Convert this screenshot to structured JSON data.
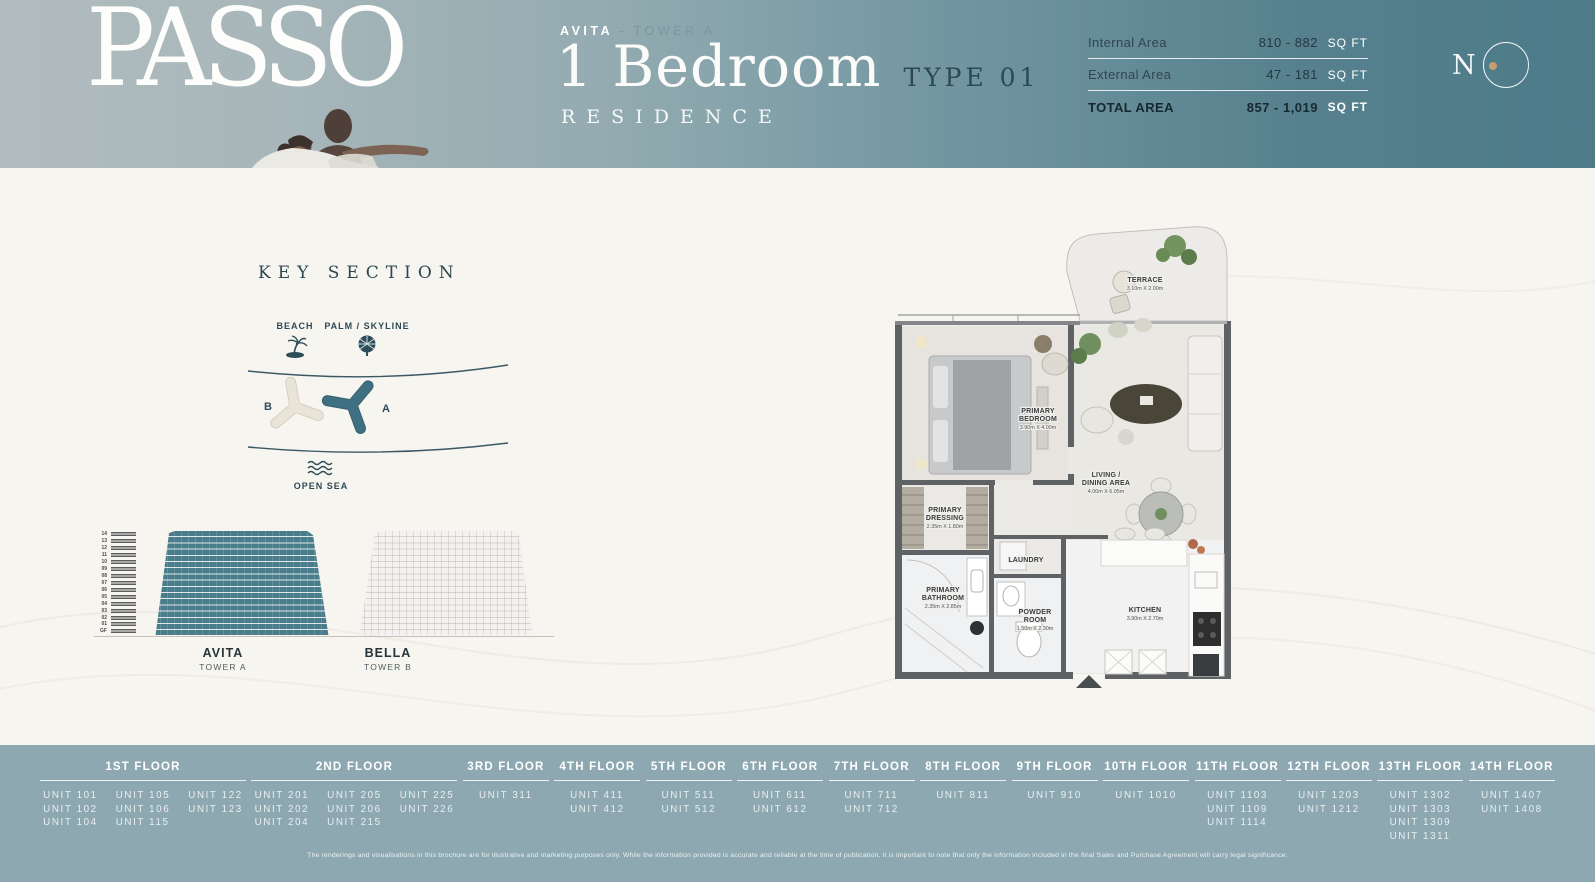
{
  "header": {
    "brand": "PASSO",
    "tower_prefix": "AVITA",
    "tower_rest": "- TOWER A",
    "title": "1 Bedroom",
    "type_label": "TYPE 01",
    "subtitle": "RESIDENCE",
    "logo_letter": "N",
    "area_table": {
      "rows": [
        {
          "label": "Internal Area",
          "value": "810 - 882",
          "unit": "SQ FT",
          "total": false
        },
        {
          "label": "External Area",
          "value": "47 - 181",
          "unit": "SQ FT",
          "total": false
        },
        {
          "label": "TOTAL AREA",
          "value": "857 - 1,019",
          "unit": "SQ FT",
          "total": true
        }
      ]
    }
  },
  "key_section": {
    "title": "KEY SECTION",
    "beach_label": "BEACH",
    "palm_label": "PALM / SKYLINE",
    "open_sea_label": "OPEN SEA",
    "tower_b_letter": "B",
    "tower_a_letter": "A"
  },
  "elevation": {
    "floor_labels": [
      "14",
      "13",
      "12",
      "11",
      "10",
      "09",
      "08",
      "07",
      "06",
      "05",
      "04",
      "03",
      "02",
      "01",
      "GF"
    ],
    "towers": [
      {
        "name": "AVITA",
        "sub": "TOWER A"
      },
      {
        "name": "BELLA",
        "sub": "TOWER B"
      }
    ]
  },
  "floor_plan": {
    "rooms": [
      {
        "line1": "TERRACE",
        "line2": "",
        "dims": "3.10m X 2.00m"
      },
      {
        "line1": "PRIMARY",
        "line2": "BEDROOM",
        "dims": "3.90m X 4.00m"
      },
      {
        "line1": "LIVING /",
        "line2": "DINING AREA",
        "dims": "4.00m X 6.05m"
      },
      {
        "line1": "PRIMARY",
        "line2": "DRESSING",
        "dims": "2.35m X 1.80m"
      },
      {
        "line1": "LAUNDRY",
        "line2": "",
        "dims": ""
      },
      {
        "line1": "PRIMARY",
        "line2": "BATHROOM",
        "dims": "2.35m X 2.85m"
      },
      {
        "line1": "POWDER",
        "line2": "ROOM",
        "dims": "1.50m X 2.30m"
      },
      {
        "line1": "KITCHEN",
        "line2": "",
        "dims": "3.90m X 2.70m"
      }
    ]
  },
  "footer": {
    "floors": [
      {
        "label": "1ST FLOOR",
        "cols": 3,
        "units": [
          "UNIT 101",
          "UNIT 105",
          "UNIT 122",
          "UNIT 102",
          "UNIT 106",
          "UNIT 123",
          "UNIT 104",
          "UNIT 115"
        ]
      },
      {
        "label": "2ND FLOOR",
        "cols": 3,
        "units": [
          "UNIT 201",
          "UNIT 205",
          "UNIT 225",
          "UNIT 202",
          "UNIT 206",
          "UNIT 226",
          "UNIT 204",
          "UNIT 215"
        ]
      },
      {
        "label": "3RD FLOOR",
        "cols": 1,
        "units": [
          "UNIT 311"
        ]
      },
      {
        "label": "4TH FLOOR",
        "cols": 1,
        "units": [
          "UNIT 411",
          "UNIT 412"
        ]
      },
      {
        "label": "5TH FLOOR",
        "cols": 1,
        "units": [
          "UNIT 511",
          "UNIT 512"
        ]
      },
      {
        "label": "6TH FLOOR",
        "cols": 1,
        "units": [
          "UNIT 611",
          "UNIT 612"
        ]
      },
      {
        "label": "7TH FLOOR",
        "cols": 1,
        "units": [
          "UNIT 711",
          "UNIT 712"
        ]
      },
      {
        "label": "8TH FLOOR",
        "cols": 1,
        "units": [
          "UNIT 811"
        ]
      },
      {
        "label": "9TH FLOOR",
        "cols": 1,
        "units": [
          "UNIT 910"
        ]
      },
      {
        "label": "10TH FLOOR",
        "cols": 1,
        "units": [
          "UNIT 1010"
        ]
      },
      {
        "label": "11TH FLOOR",
        "cols": 1,
        "units": [
          "UNIT 1103",
          "UNIT 1109",
          "UNIT 1114"
        ]
      },
      {
        "label": "12TH FLOOR",
        "cols": 1,
        "units": [
          "UNIT 1203",
          "UNIT 1212"
        ]
      },
      {
        "label": "13TH FLOOR",
        "cols": 1,
        "units": [
          "UNIT 1302",
          "UNIT 1303",
          "UNIT 1309",
          "UNIT 1311"
        ]
      },
      {
        "label": "14TH FLOOR",
        "cols": 1,
        "units": [
          "UNIT 1407",
          "UNIT 1408"
        ]
      }
    ],
    "disclaimer": "The renderings and visualisations in this brochure are for illustrative and marketing purposes only. While the information provided is accurate and reliable at the time of publication, it is important to note that only the information included in the final Sales and Purchase Agreement will carry legal significance."
  },
  "colors": {
    "header_teal": "#4d7b89",
    "header_light": "#b1bcbe",
    "accent_dark": "#2d4955",
    "tower_a_teal": "#4a7d8c",
    "tower_b_cream": "#e9e4d8",
    "footer_bg": "#8da8b1",
    "gold_dot": "#c59d6e",
    "body_bg": "#f7f5f0"
  }
}
